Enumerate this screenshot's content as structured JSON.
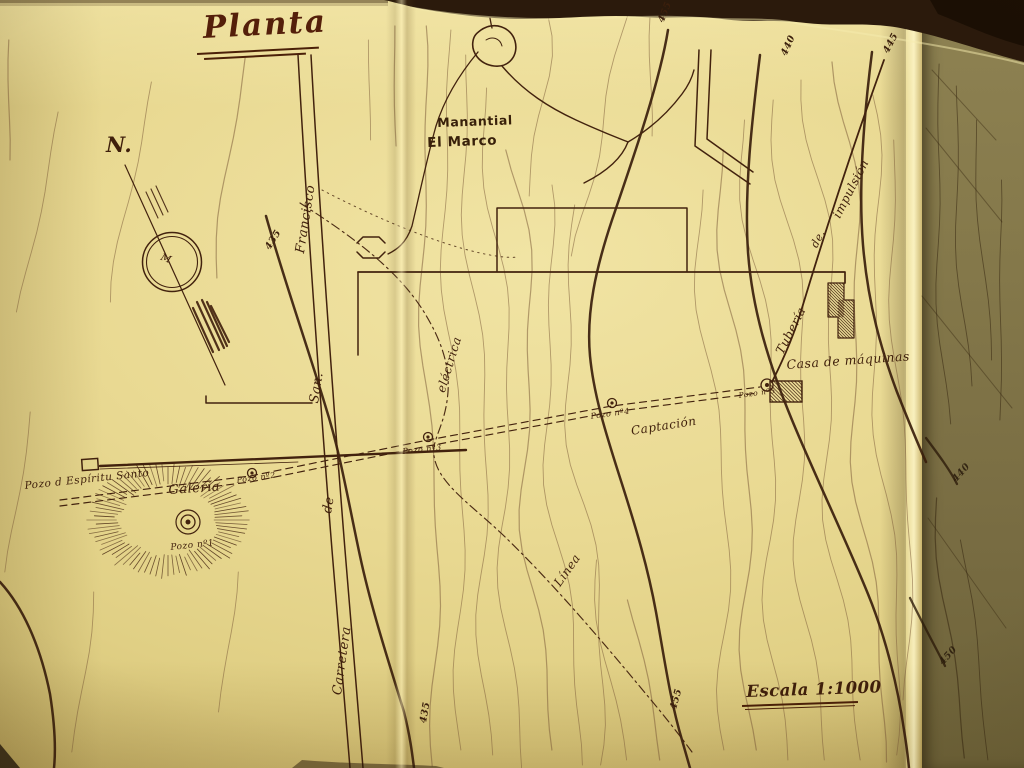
{
  "title": {
    "text": "Planta"
  },
  "compass": {
    "label": "N.",
    "center_glyph": "M"
  },
  "spring": {
    "line1": "Manantial",
    "line2": "El Marco"
  },
  "road_label": {
    "word1": "Carretera",
    "word2": "de",
    "word3": "San.",
    "word4": "Francisco"
  },
  "pipeline_label": {
    "word1": "Tubería",
    "word2": "de.",
    "word3": "impulsión"
  },
  "electric_label": {
    "word1": "Línea",
    "word2": "eléctrica"
  },
  "features": {
    "machine_house": "Casa de máquinas",
    "captacion": "Captación",
    "galeria": "Galería",
    "spring_well_name": "Pozo d Espíritu Santo"
  },
  "wells": {
    "w1": "Pozo nº1",
    "w2": "Pozo nº2",
    "w3": "Pozo nº3",
    "w4": "Pozo nº4",
    "w5": "Pozo nº5"
  },
  "scale": {
    "text": "Escala 1:1000"
  },
  "contour_labels": [
    {
      "value": "455"
    },
    {
      "value": "440"
    },
    {
      "value": "445"
    },
    {
      "value": "435"
    },
    {
      "value": "435"
    },
    {
      "value": "455"
    },
    {
      "value": "440"
    },
    {
      "value": "450"
    }
  ],
  "colors": {
    "ink": "#42220e",
    "ink_dark": "#33180a",
    "contour_light": "#7d5c3a",
    "paper": "#e7d68c",
    "paper_bright": "#f2e6a8",
    "panel_shadow": "#7f744a",
    "background": "#2b1a0c",
    "title_ink": "#541f0a"
  }
}
